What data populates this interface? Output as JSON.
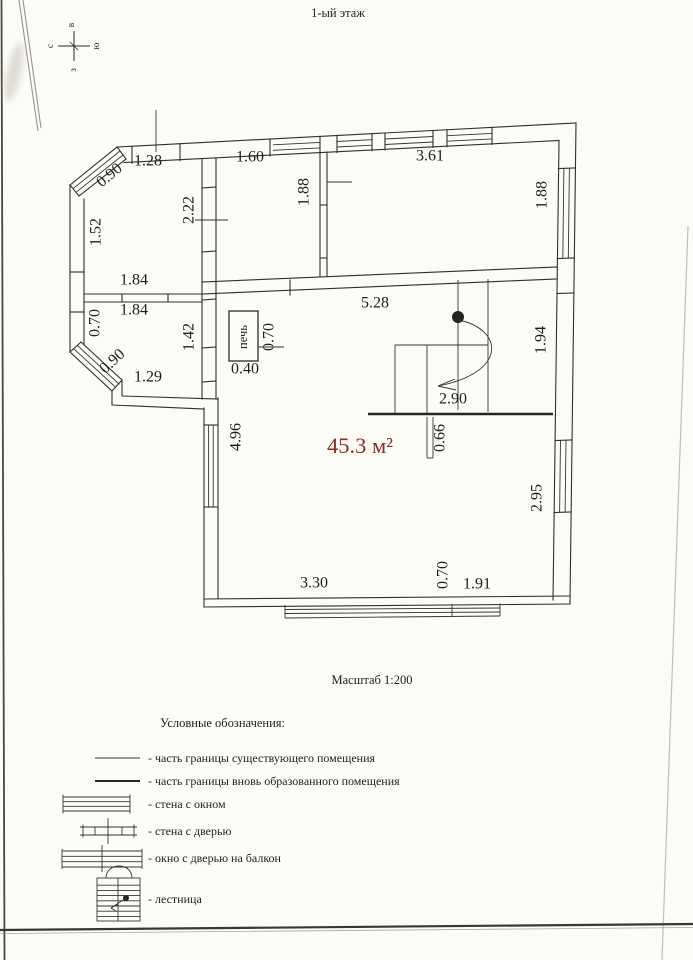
{
  "title": "1-ый этаж",
  "scale_note": "Масштаб 1:200",
  "area": "45.3 м²",
  "stove": "печь",
  "compass": {
    "n": "с",
    "e": "в",
    "s": "ю",
    "w": "з"
  },
  "dims": [
    {
      "v": "1.28",
      "x": 148,
      "y": 162,
      "r": 0
    },
    {
      "v": "0.90",
      "x": 110,
      "y": 176,
      "r": -40
    },
    {
      "v": "1.60",
      "x": 250,
      "y": 158,
      "r": 0
    },
    {
      "v": "3.61",
      "x": 430,
      "y": 157,
      "r": 0
    },
    {
      "v": "1.88",
      "x": 305,
      "y": 192,
      "r": -90
    },
    {
      "v": "1.88",
      "x": 543,
      "y": 195,
      "r": -90
    },
    {
      "v": "2.22",
      "x": 190,
      "y": 210,
      "r": -90
    },
    {
      "v": "1.52",
      "x": 97,
      "y": 232,
      "r": -90
    },
    {
      "v": "1.84",
      "x": 134,
      "y": 281,
      "r": 0
    },
    {
      "v": "1.84",
      "x": 134,
      "y": 311,
      "r": 0
    },
    {
      "v": "0.70",
      "x": 96,
      "y": 323,
      "r": -90
    },
    {
      "v": "0.90",
      "x": 113,
      "y": 362,
      "r": -43
    },
    {
      "v": "1.29",
      "x": 148,
      "y": 378,
      "r": 0
    },
    {
      "v": "1.42",
      "x": 190,
      "y": 337,
      "r": -90
    },
    {
      "v": "5.28",
      "x": 375,
      "y": 304,
      "r": 0
    },
    {
      "v": "0.70",
      "x": 270,
      "y": 337,
      "r": -90
    },
    {
      "v": "0.40",
      "x": 245,
      "y": 370,
      "r": 0
    },
    {
      "v": "1.94",
      "x": 542,
      "y": 340,
      "r": -90
    },
    {
      "v": "2.90",
      "x": 453,
      "y": 400,
      "r": 0
    },
    {
      "v": "4.96",
      "x": 237,
      "y": 437,
      "r": -90
    },
    {
      "v": "0.66",
      "x": 441,
      "y": 438,
      "r": -90
    },
    {
      "v": "2.95",
      "x": 538,
      "y": 498,
      "r": -90
    },
    {
      "v": "0.70",
      "x": 444,
      "y": 575,
      "r": -90
    },
    {
      "v": "1.91",
      "x": 477,
      "y": 585,
      "r": 0
    },
    {
      "v": "3.30",
      "x": 314,
      "y": 584,
      "r": 0
    }
  ],
  "legend": {
    "heading": "Условные обозначения:",
    "items": [
      {
        "symbol": "existing-boundary-line",
        "label": "- часть границы существующего помещения"
      },
      {
        "symbol": "new-boundary-line",
        "label": "- часть границы вновь образованного помещения"
      },
      {
        "symbol": "wall-with-window",
        "label": "- стена с окном"
      },
      {
        "symbol": "wall-with-door",
        "label": "- стена с дверью"
      },
      {
        "symbol": "window-with-balcony-door",
        "label": "- окно с дверью на балкон"
      },
      {
        "symbol": "staircase",
        "label": "- лестница"
      }
    ]
  }
}
